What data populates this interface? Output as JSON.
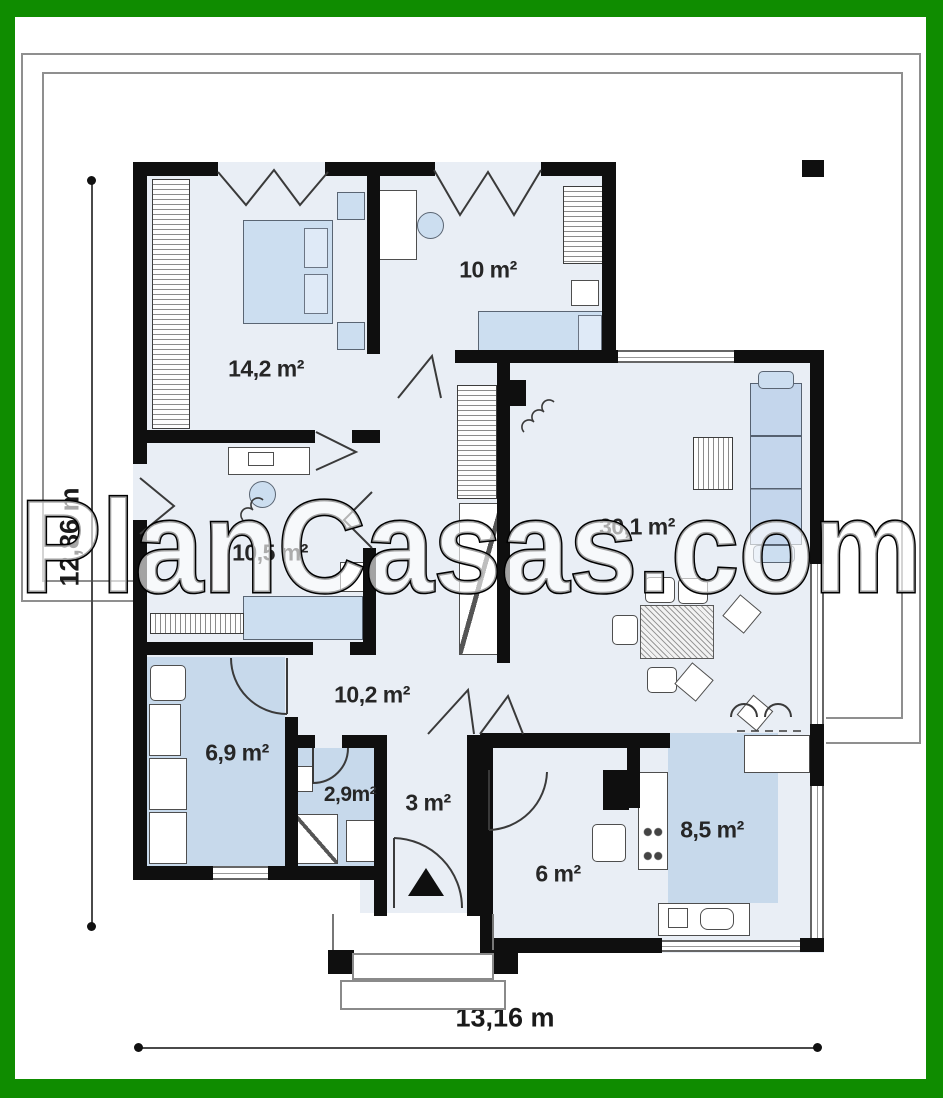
{
  "watermark": {
    "text": "PlanCasas.com"
  },
  "dimensions": {
    "height_label": "12,86 m",
    "width_label": "13,16 m"
  },
  "rooms": [
    {
      "id": "bedroom-1",
      "area_label": "14,2 m²"
    },
    {
      "id": "bedroom-2",
      "area_label": "10 m²"
    },
    {
      "id": "bedroom-3",
      "area_label": "10,5 m²"
    },
    {
      "id": "living-room",
      "area_label": "30,1 m²"
    },
    {
      "id": "hall",
      "area_label": "10,2 m²"
    },
    {
      "id": "bathroom",
      "area_label": "6,9 m²"
    },
    {
      "id": "wc",
      "area_label": "2,9m²"
    },
    {
      "id": "vestibule",
      "area_label": "3 m²"
    },
    {
      "id": "utility",
      "area_label": "6 m²"
    },
    {
      "id": "kitchen",
      "area_label": "8,5 m²"
    }
  ],
  "colors": {
    "frame_green": "#0f8c00",
    "wall_black": "#0f0f0f",
    "floor_fill": "#e9eef5",
    "wet_room_fill": "#c7d9eb",
    "furniture_fill": "#ccdef0"
  }
}
